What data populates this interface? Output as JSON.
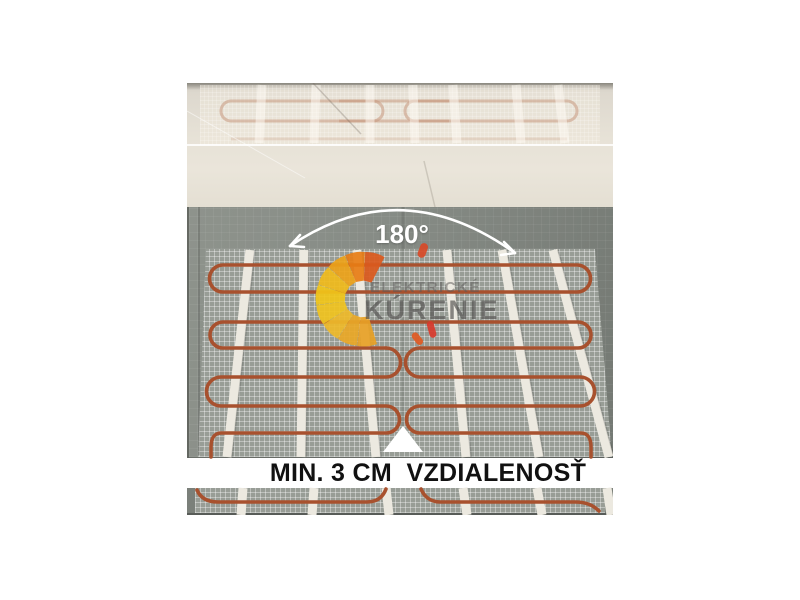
{
  "annotations": {
    "angle_label": "180°",
    "caption": "MIN. 3 CM  VZDIALENOSŤ"
  },
  "watermark": {
    "line1": "ELEKTRICKÉ",
    "line2": "KÚRENIE"
  },
  "colors": {
    "background": "#ffffff",
    "substrate_gray": "#7d827c",
    "mat_mesh_gray": "#989d96",
    "heating_cable_orange": "#a8512e",
    "fixing_strap_white": "#ece9e0",
    "overexposed_ceiling_beige": "#e2ddd2",
    "annotation_white": "#ffffff",
    "caption_black": "#111111",
    "logo_yellow": "#f2c41c",
    "logo_orange": "#e87d15",
    "logo_red": "#d83a2c"
  }
}
